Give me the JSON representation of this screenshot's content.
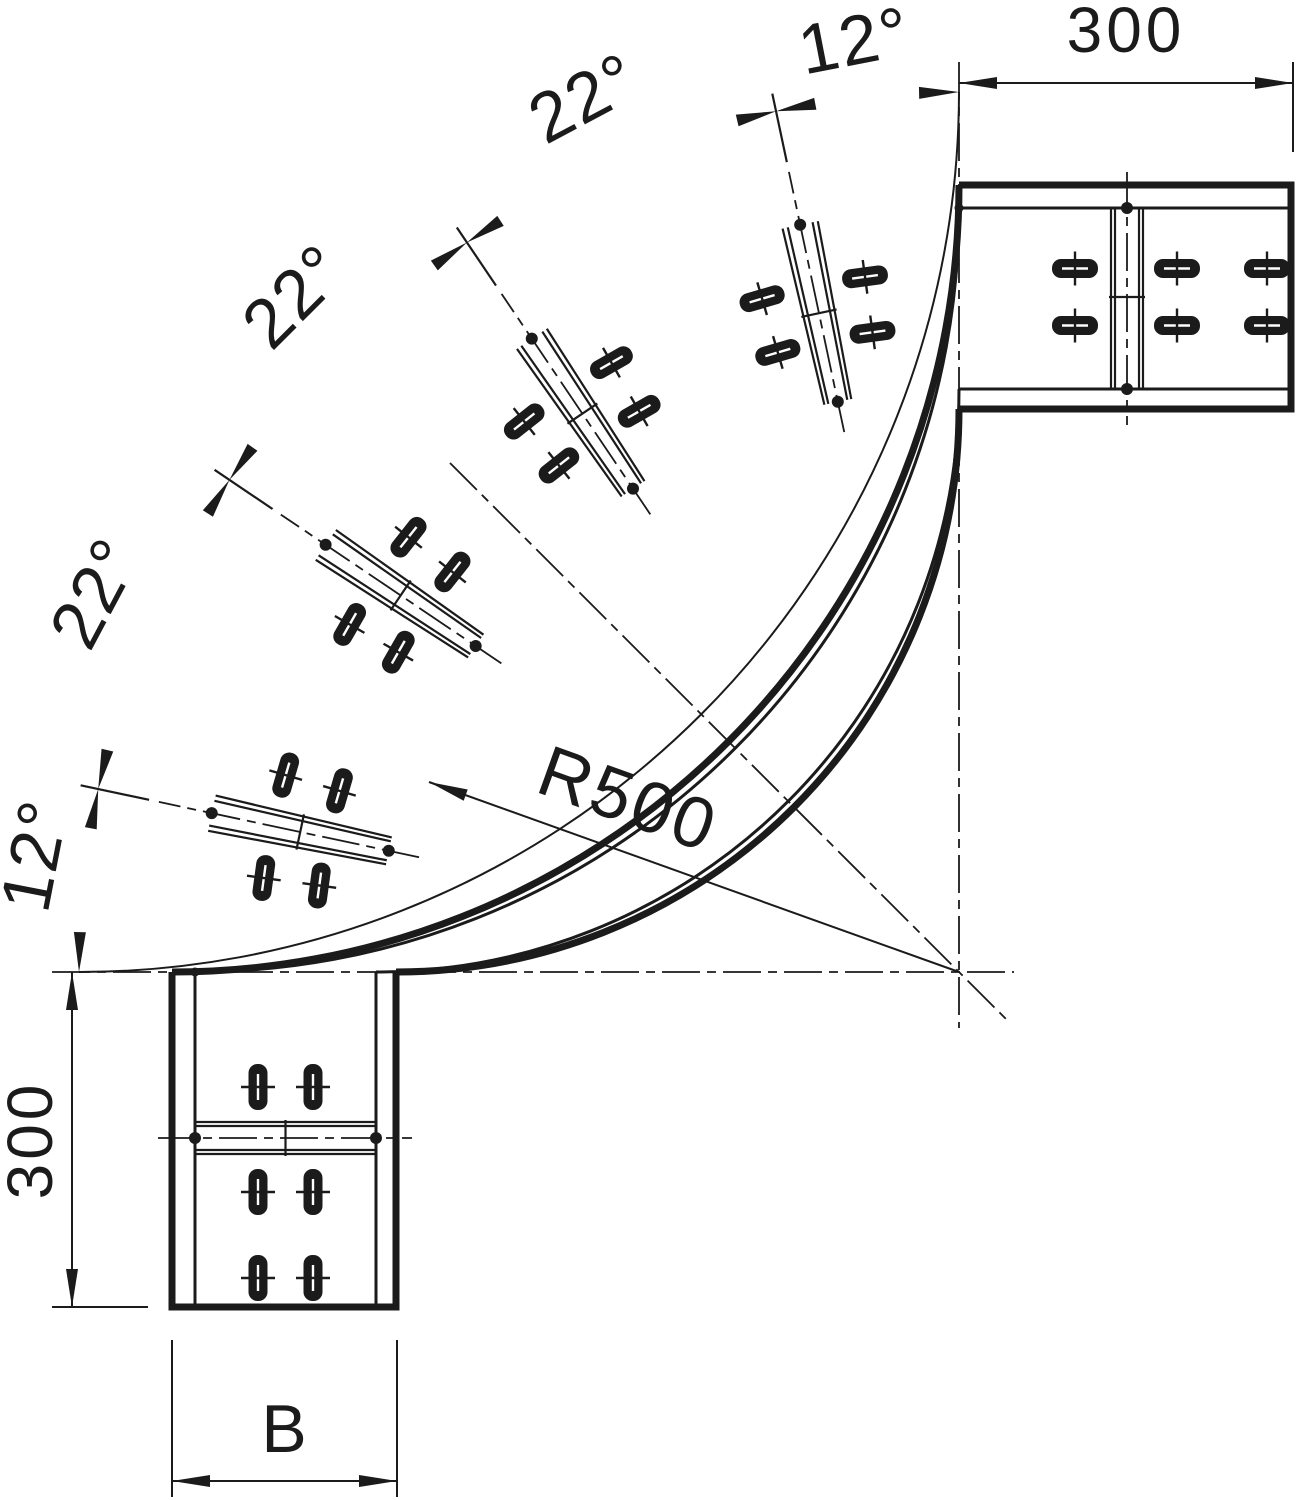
{
  "drawing": {
    "kind": "90-degree cable tray bend, plan view",
    "background": "#ffffff",
    "line_color": "#1b1b1b"
  },
  "dimensions": {
    "top_length": "300",
    "side_length": "300",
    "width": "B",
    "radius": "R500",
    "segment_angles": [
      "12°",
      "22°",
      "22°",
      "22°",
      "12°"
    ]
  },
  "geometry_data": {
    "segment_angles_deg": [
      12,
      22,
      22,
      22,
      12
    ],
    "total_bend_deg": 90,
    "joint_positions_deg_from_top": [
      12,
      34,
      56,
      78
    ],
    "straight_end_length": 300,
    "bend_radius_label_value": 500
  }
}
